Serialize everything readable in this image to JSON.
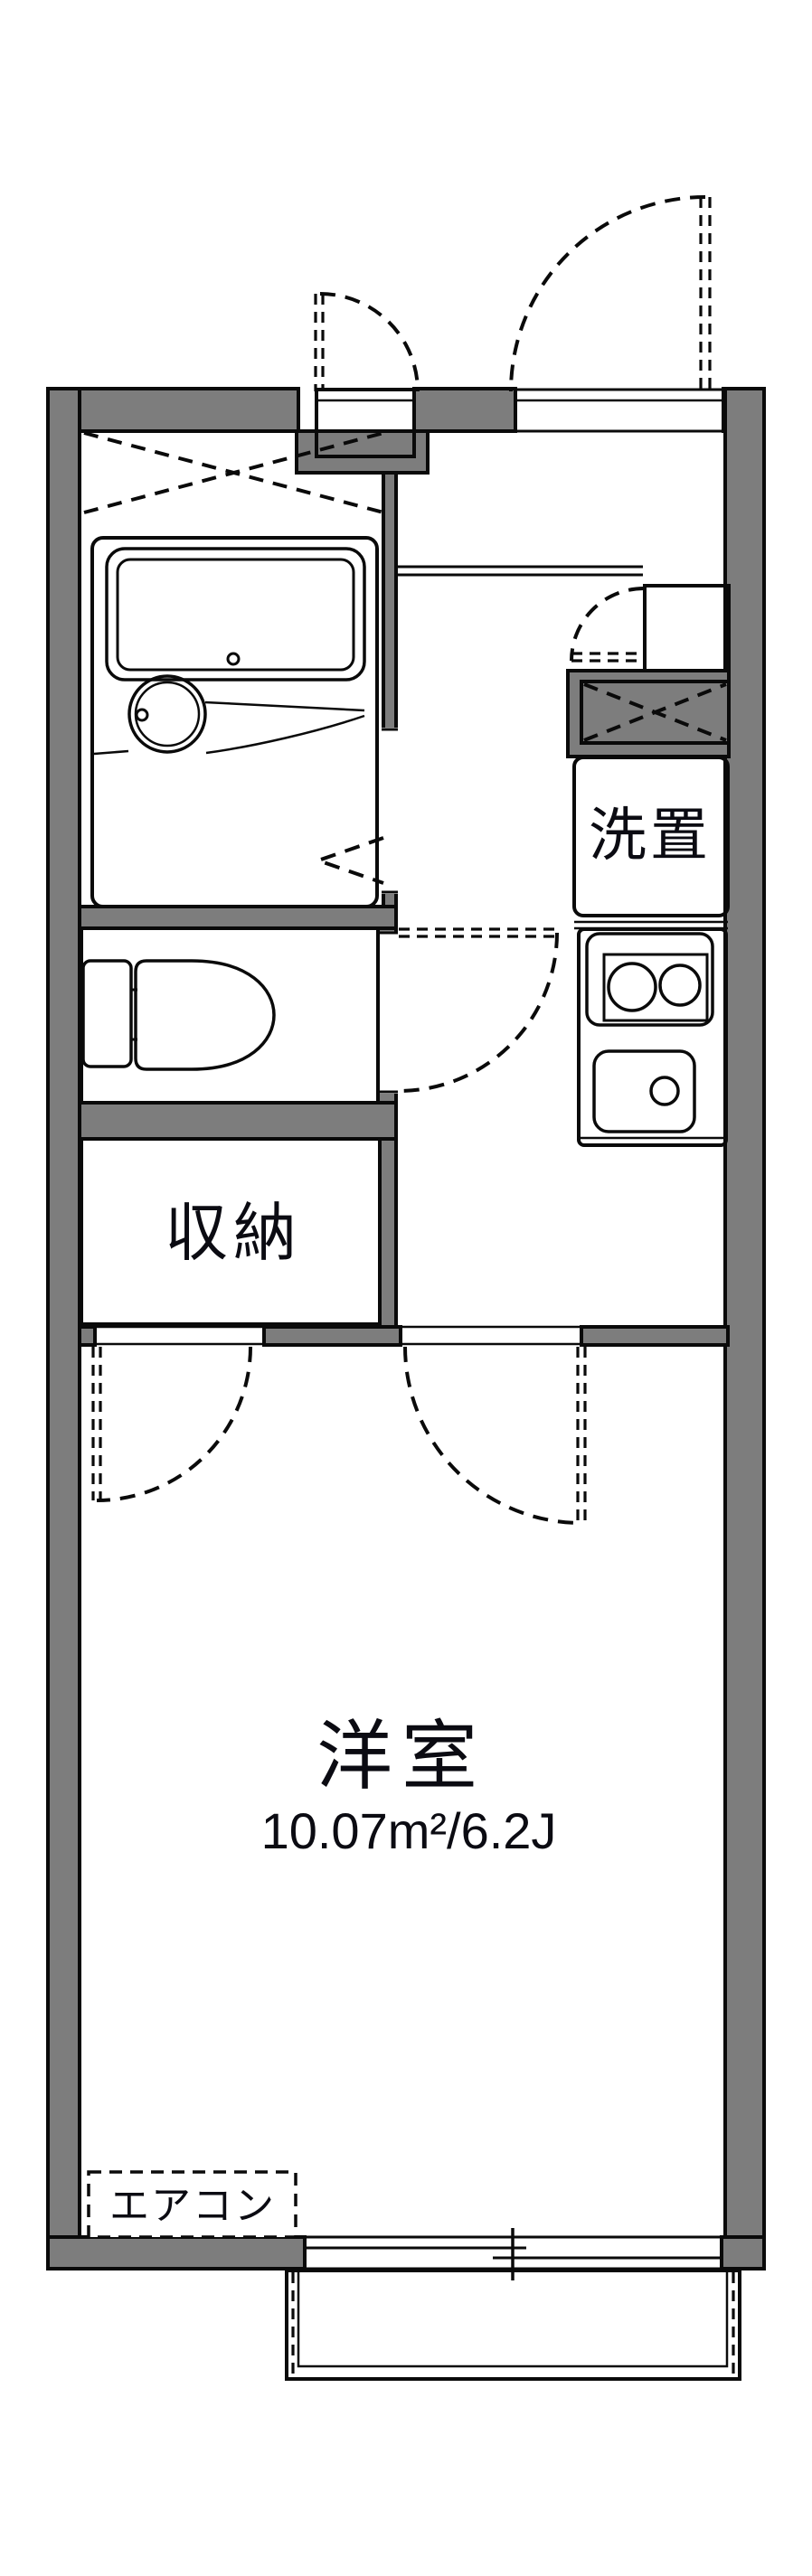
{
  "labels": {
    "laundry": "洗置",
    "closet": "収納",
    "main_room": "洋室",
    "main_room_area": "10.07m²/6.2J",
    "aircon": "エアコン"
  },
  "colors": {
    "wall_fill": "#7d7d7d",
    "outline": "#0a0a0a",
    "water_area_fill": "#dce8f7",
    "bath_inner_fill": "#e9f1fb",
    "storage_fill": "#fcf1d6",
    "label_color": "#0b0b12"
  },
  "plan": {
    "type": "apartment-floor-plan",
    "main_room_area_m2": "10.07",
    "main_room_area_jo": "6.2J"
  }
}
